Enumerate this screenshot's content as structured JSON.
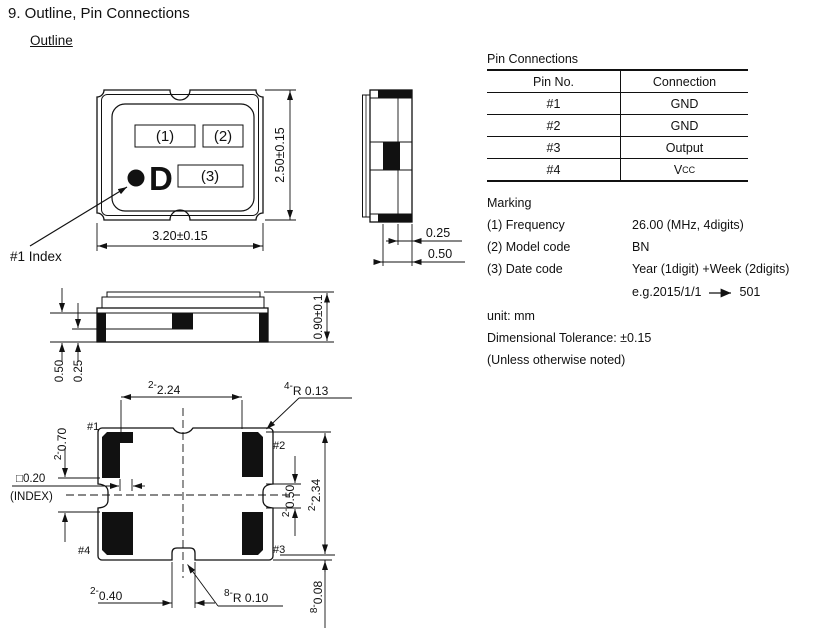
{
  "page": {
    "title": "9. Outline, Pin Connections",
    "section_heading": "Outline"
  },
  "top_view": {
    "marking1": "(1)",
    "marking2": "(2)",
    "marking3": "(3)",
    "letter": "D",
    "index_label": "#1 Index",
    "dim_width": "3.20±0.15",
    "dim_height": "2.50±0.15"
  },
  "side_view": {
    "dim_pad": "0.25",
    "dim_terminal": "0.50"
  },
  "front_view": {
    "dim_height": "0.90±0.1",
    "dim_a": "0.50",
    "dim_b": "0.25"
  },
  "bottom_view": {
    "pads": {
      "p1": "#1",
      "p2": "#2",
      "p3": "#3",
      "p4": "#4"
    },
    "dim_pitch_x": {
      "prefix": "2-",
      "value": "2.24"
    },
    "dim_corner_r": {
      "prefix": "4-",
      "value": "R 0.13"
    },
    "dim_pad_gap": {
      "prefix": "2-",
      "value": "0.70"
    },
    "dim_index": "□0.20",
    "dim_index_note": "(INDEX)",
    "dim_notch_h": {
      "prefix": "2-",
      "value": "0.50"
    },
    "dim_pitch_y": {
      "prefix": "2-",
      "value": "2.34"
    },
    "dim_edge_gap": {
      "prefix": "8-",
      "value": "0.08"
    },
    "dim_notch_w": {
      "prefix": "2-",
      "value": "0.40"
    },
    "dim_notch_r": {
      "prefix": "8-",
      "value": "R 0.10"
    }
  },
  "pin_connections": {
    "title": "Pin Connections",
    "headers": [
      "Pin No.",
      "Connection"
    ],
    "rows": [
      {
        "pin": "#1",
        "connection": "GND"
      },
      {
        "pin": "#2",
        "connection": "GND"
      },
      {
        "pin": "#3",
        "connection": "Output"
      },
      {
        "pin": "#4",
        "connection": "V",
        "connection_sub": "CC"
      }
    ]
  },
  "marking": {
    "title": "Marking",
    "items": [
      {
        "label": "(1) Frequency",
        "value": "26.00 (MHz, 4digits)"
      },
      {
        "label": "(2) Model code",
        "value": "BN"
      },
      {
        "label": "(3) Date code",
        "value": "Year (1digit) +Week (2digits)"
      }
    ],
    "example": {
      "text": "e.g.2015/1/1",
      "result": "501"
    }
  },
  "notes": {
    "unit": "unit: mm",
    "tolerance": "Dimensional Tolerance: ±0.15",
    "condition": "(Unless otherwise noted)"
  }
}
